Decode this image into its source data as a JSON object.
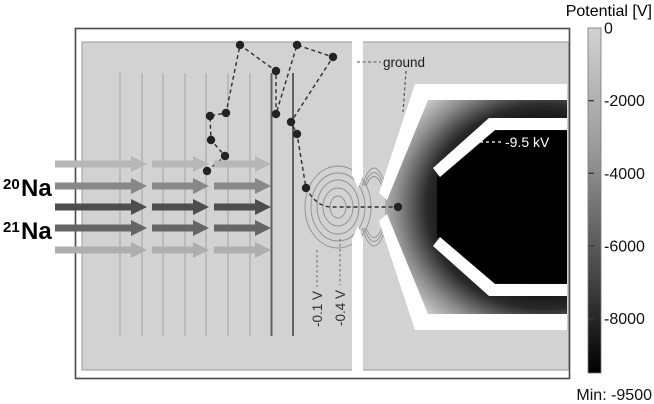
{
  "figure": {
    "description_labels": {
      "ground": "ground",
      "electrode_voltage": "-9.5 kV",
      "equipotential_outer": "-0.1 V",
      "equipotential_inner": "-0.4 V"
    },
    "beams": {
      "isotope_top": {
        "mass": "20",
        "element": "Na"
      },
      "isotope_bottom": {
        "mass": "21",
        "element": "Na"
      },
      "rows": [
        {
          "y": 164,
          "color": "#b7b7b7"
        },
        {
          "y": 186,
          "color": "#888888"
        },
        {
          "y": 207,
          "color": "#4d4d4d"
        },
        {
          "y": 228,
          "color": "#656565"
        },
        {
          "y": 250,
          "color": "#aeaeae"
        }
      ],
      "segments": [
        [
          55,
          147
        ],
        [
          152,
          209
        ],
        [
          214,
          271
        ]
      ]
    },
    "grid_lines": {
      "light_x": [
        120,
        142,
        163,
        185,
        206,
        228,
        250
      ],
      "dark_x": [
        271.5,
        293
      ],
      "y_top": 73,
      "y_bottom": 336
    },
    "trajectory": {
      "dots": [
        [
          207,
          171
        ],
        [
          225,
          156
        ],
        [
          211,
          140
        ],
        [
          210,
          116
        ],
        [
          226,
          113
        ],
        [
          240,
          45
        ],
        [
          276,
          71
        ],
        [
          276,
          114
        ],
        [
          297,
          45
        ],
        [
          333,
          57
        ],
        [
          291,
          122
        ],
        [
          297,
          134
        ],
        [
          306,
          188
        ],
        [
          398,
          207
        ]
      ]
    },
    "contours": {
      "center": [
        338,
        207
      ],
      "radii": [
        [
          8,
          11
        ],
        [
          15,
          19
        ],
        [
          21,
          27
        ],
        [
          27,
          34
        ],
        [
          33,
          41
        ]
      ]
    }
  },
  "colorbar": {
    "title": "Potential [V]",
    "min_label": "Min: -9500",
    "range_max": 0,
    "range_min": -9500,
    "color_top": "#d2d2d2",
    "color_bottom": "#000000",
    "ticks": [
      {
        "label": "0",
        "value": 0
      },
      {
        "label": "-2000",
        "value": -2000
      },
      {
        "label": "-4000",
        "value": -4000
      },
      {
        "label": "-6000",
        "value": -6000
      },
      {
        "label": "-8000",
        "value": -8000
      }
    ]
  }
}
